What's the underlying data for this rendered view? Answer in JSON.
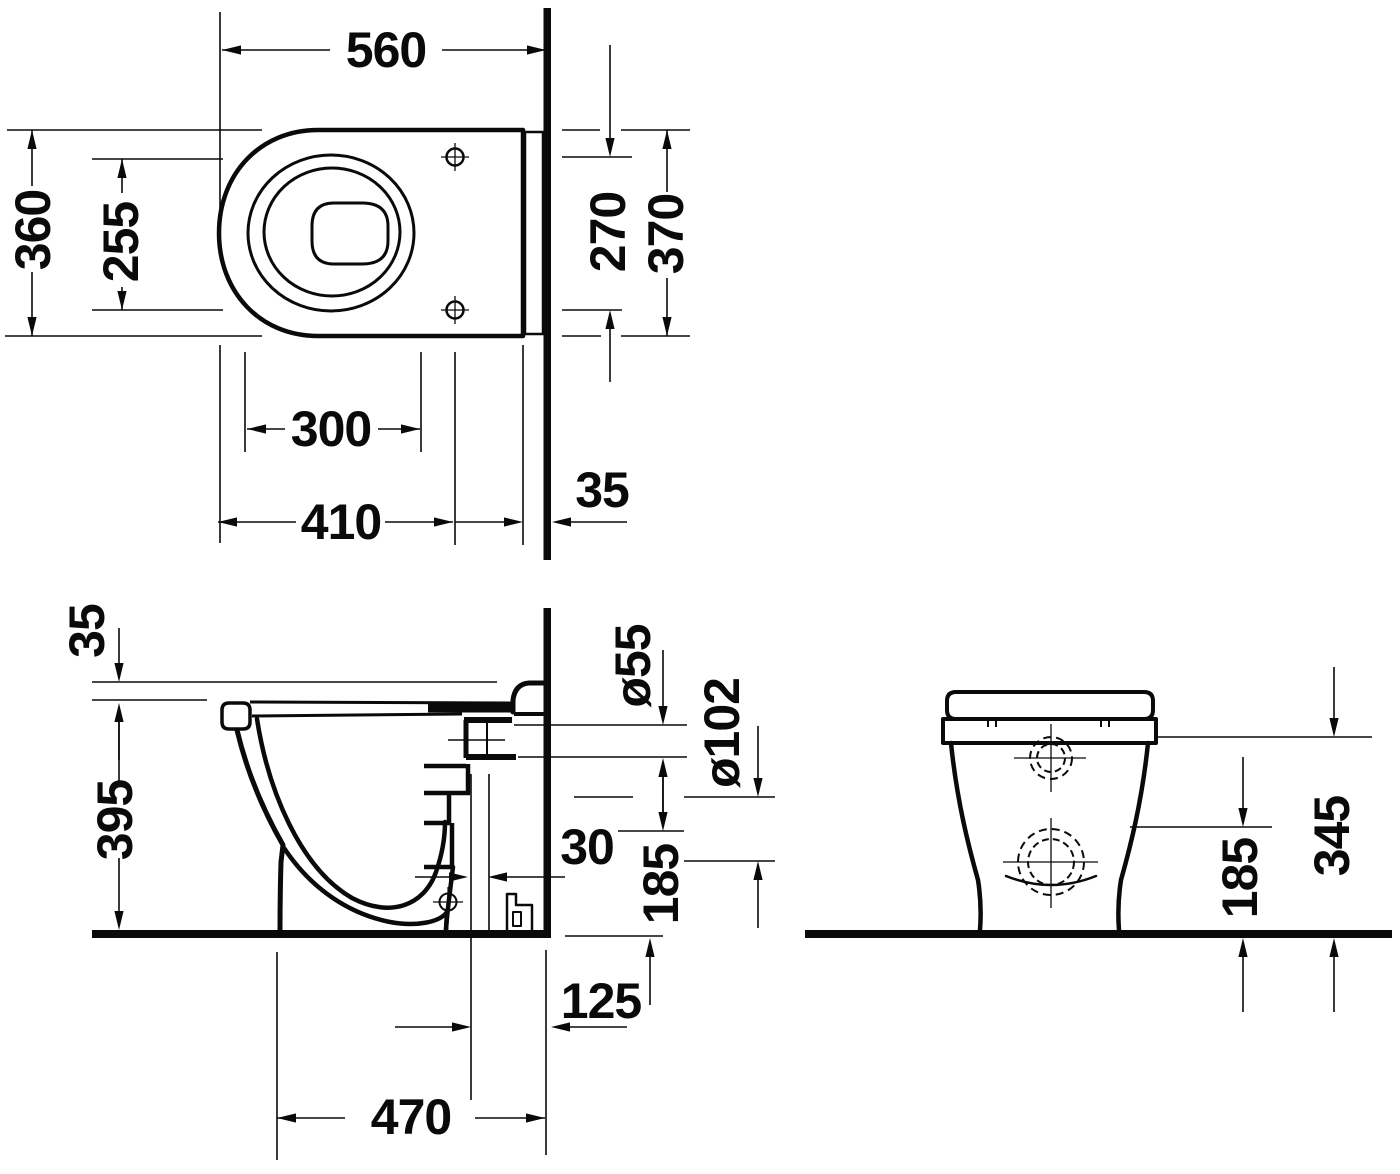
{
  "page": {
    "background": "#ffffff",
    "line_color": "#0a0a0a"
  },
  "drawing": {
    "subject": "floor-standing back-to-wall toilet — dimensional technical drawing",
    "units": "mm",
    "views": [
      {
        "id": "top",
        "name": "top view (plan)",
        "dims": {
          "overall_depth": "560",
          "overall_width": "360",
          "seat_opening_width": "255",
          "fixing_hole_spacing": "270",
          "rear_width": "370",
          "opening_depth": "300",
          "fixing_hole_distance": "410",
          "wall_gap": "35"
        }
      },
      {
        "id": "side",
        "name": "side view (section)",
        "dims": {
          "seat_step_height": "35",
          "rim_height": "395",
          "outlet_diameter": "ø55",
          "floor_outlet_diameter": "ø102",
          "outlet_offset": "30",
          "outlet_center_height": "185",
          "floor_outlet_wall_distance": "125",
          "fixing_distance_from_wall": "470"
        }
      },
      {
        "id": "rear",
        "name": "rear view",
        "dims": {
          "body_top_height": "345",
          "outlet_center_height": "185"
        }
      }
    ]
  }
}
